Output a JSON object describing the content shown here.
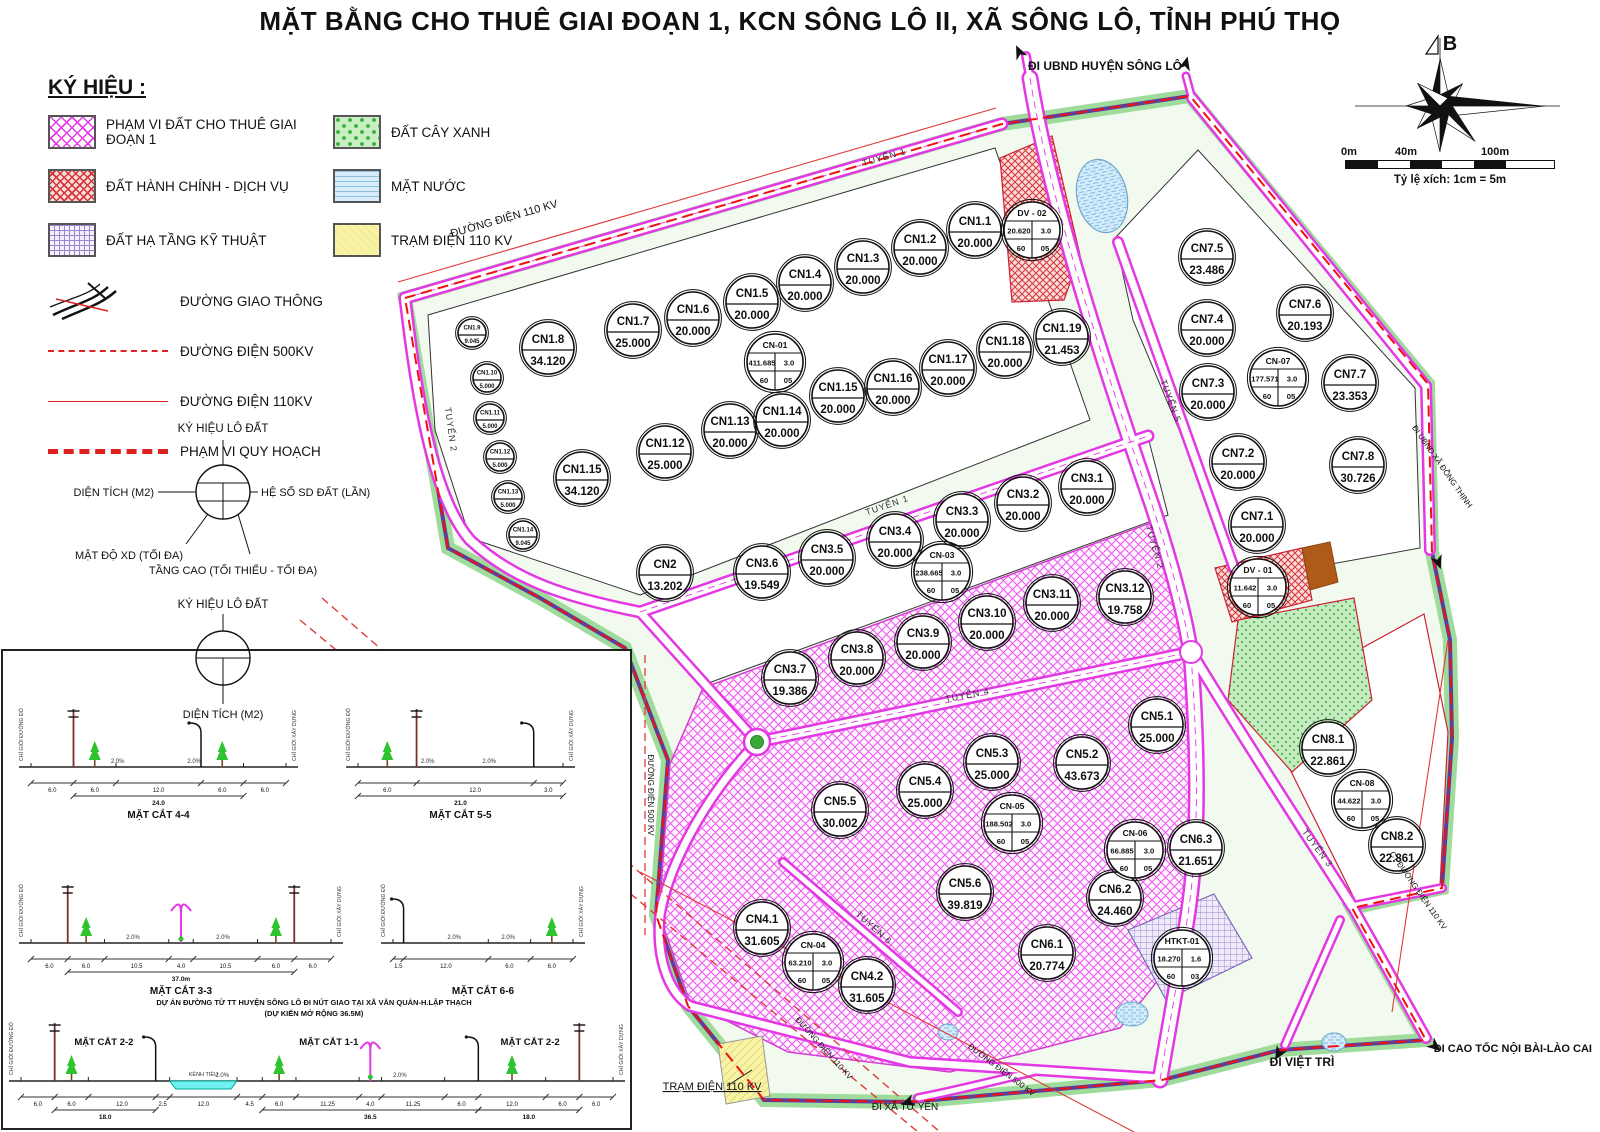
{
  "title": "MẶT BẰNG CHO THUÊ GIAI ĐOẠN 1, KCN SÔNG LÔ II, XÃ SÔNG LÔ, TỈNH PHÚ THỌ",
  "legend": {
    "heading": "KÝ HIỆU :",
    "area_items": [
      {
        "label": "PHẠM VI ĐẤT CHO THUÊ GIAI ĐOẠN 1",
        "k": "phase1"
      },
      {
        "label": "ĐẤT HÀNH CHÍNH - DỊCH VỤ",
        "k": "admin"
      },
      {
        "label": "ĐẤT HẠ TẦNG KỸ THUẬT",
        "k": "htkt"
      },
      {
        "label": "ĐẤT CÂY XANH",
        "k": "green"
      },
      {
        "label": "MẶT NƯỚC",
        "k": "water"
      },
      {
        "label": "TRẠM ĐIỆN 110 KV",
        "k": "power"
      }
    ],
    "line_items": [
      {
        "label": "ĐƯỜNG GIAO THÔNG",
        "k": "road"
      },
      {
        "label": "ĐƯỜNG ĐIỆN 500KV",
        "k": "e500"
      },
      {
        "label": "ĐƯỜNG ĐIỆN 110KV",
        "k": "e110"
      },
      {
        "label": "PHẠM VI QUY HOẠCH",
        "k": "bound"
      }
    ],
    "lot_symbol_full": {
      "title": "KÝ HIỆU LÔ ĐẤT",
      "left": "DIỆN TÍCH (M2)",
      "right": "HỆ SỐ SD ĐẤT (LẦN)",
      "bottom_left": "MẬT ĐỘ XD (TỐI ĐA)",
      "bottom": "TẦNG CAO (TỐI THIỂU - TỐI ĐA)"
    },
    "lot_symbol_simple": {
      "title": "KÝ HIỆU LÔ ĐẤT",
      "bottom": "DIỆN TÍCH (M2)"
    }
  },
  "compass": {
    "north_label": "B"
  },
  "scalebar": {
    "ticks": [
      "0m",
      "40m",
      "100m"
    ],
    "caption": "Tỷ lệ xích: 1cm = 5m"
  },
  "map": {
    "lots": [
      {
        "id": "CN1.8",
        "a": "34.120",
        "x": 548,
        "y": 348
      },
      {
        "id": "CN1.7",
        "a": "25.000",
        "x": 633,
        "y": 330
      },
      {
        "id": "CN1.6",
        "a": "20.000",
        "x": 693,
        "y": 318
      },
      {
        "id": "CN1.5",
        "a": "20.000",
        "x": 752,
        "y": 302
      },
      {
        "id": "CN1.4",
        "a": "20.000",
        "x": 805,
        "y": 283
      },
      {
        "id": "CN1.3",
        "a": "20.000",
        "x": 863,
        "y": 267
      },
      {
        "id": "CN1.2",
        "a": "20.000",
        "x": 920,
        "y": 248
      },
      {
        "id": "CN1.1",
        "a": "20.000",
        "x": 975,
        "y": 230
      },
      {
        "id": "DV - 02",
        "v": [
          "20.620",
          "3.0",
          "60",
          "05"
        ],
        "x": 1032,
        "y": 230
      },
      {
        "id": "CN-01",
        "v": [
          "411.685",
          "3.0",
          "60",
          "05"
        ],
        "x": 775,
        "y": 362
      },
      {
        "id": "CN1.15",
        "a": "34.120",
        "x": 582,
        "y": 478
      },
      {
        "id": "CN1.12",
        "a": "25.000",
        "x": 665,
        "y": 452
      },
      {
        "id": "CN1.13",
        "a": "20.000",
        "x": 730,
        "y": 430
      },
      {
        "id": "CN1.14",
        "a": "20.000",
        "x": 782,
        "y": 420
      },
      {
        "id": "CN1.15",
        "a": "20.000",
        "x": 838,
        "y": 396
      },
      {
        "id": "CN1.16",
        "a": "20.000",
        "x": 893,
        "y": 387
      },
      {
        "id": "CN1.17",
        "a": "20.000",
        "x": 948,
        "y": 368
      },
      {
        "id": "CN1.18",
        "a": "20.000",
        "x": 1005,
        "y": 350
      },
      {
        "id": "CN1.19",
        "a": "21.453",
        "x": 1062,
        "y": 337
      },
      {
        "id": "CN1.9",
        "a": "9.045",
        "s": 1,
        "x": 472,
        "y": 333
      },
      {
        "id": "CN1.10",
        "a": "5.000",
        "s": 1,
        "x": 487,
        "y": 378
      },
      {
        "id": "CN1.11",
        "a": "5.000",
        "s": 1,
        "x": 490,
        "y": 418
      },
      {
        "id": "CN1.12",
        "a": "5.000",
        "s": 1,
        "x": 500,
        "y": 457
      },
      {
        "id": "CN1.13",
        "a": "5.000",
        "s": 1,
        "x": 508,
        "y": 497
      },
      {
        "id": "CN1.14",
        "a": "9.045",
        "s": 1,
        "x": 523,
        "y": 535
      },
      {
        "id": "CN2",
        "a": "13.202",
        "x": 665,
        "y": 573
      },
      {
        "id": "CN3.6",
        "a": "19.549",
        "x": 762,
        "y": 572
      },
      {
        "id": "CN3.5",
        "a": "20.000",
        "x": 827,
        "y": 558
      },
      {
        "id": "CN3.4",
        "a": "20.000",
        "x": 895,
        "y": 540
      },
      {
        "id": "CN3.3",
        "a": "20.000",
        "x": 962,
        "y": 520
      },
      {
        "id": "CN3.2",
        "a": "20.000",
        "x": 1023,
        "y": 503
      },
      {
        "id": "CN3.1",
        "a": "20.000",
        "x": 1087,
        "y": 487
      },
      {
        "id": "CN-03",
        "v": [
          "238.665",
          "3.0",
          "60",
          "05"
        ],
        "x": 942,
        "y": 572
      },
      {
        "id": "CN3.7",
        "a": "19.386",
        "x": 790,
        "y": 678
      },
      {
        "id": "CN3.8",
        "a": "20.000",
        "x": 857,
        "y": 658
      },
      {
        "id": "CN3.9",
        "a": "20.000",
        "x": 923,
        "y": 642
      },
      {
        "id": "CN3.10",
        "a": "20.000",
        "x": 987,
        "y": 622
      },
      {
        "id": "CN3.11",
        "a": "20.000",
        "x": 1052,
        "y": 603
      },
      {
        "id": "CN3.12",
        "a": "19.758",
        "x": 1125,
        "y": 597
      },
      {
        "id": "CN5.1",
        "a": "25.000",
        "x": 1157,
        "y": 725
      },
      {
        "id": "CN5.2",
        "a": "43.673",
        "x": 1082,
        "y": 763
      },
      {
        "id": "CN5.3",
        "a": "25.000",
        "x": 992,
        "y": 762
      },
      {
        "id": "CN5.4",
        "a": "25.000",
        "x": 925,
        "y": 790
      },
      {
        "id": "CN5.5",
        "a": "30.002",
        "x": 840,
        "y": 810
      },
      {
        "id": "CN-05",
        "v": [
          "188.502",
          "3.0",
          "60",
          "05"
        ],
        "x": 1012,
        "y": 823
      },
      {
        "id": "CN5.6",
        "a": "39.819",
        "x": 965,
        "y": 892
      },
      {
        "id": "CN6.1",
        "a": "20.774",
        "x": 1047,
        "y": 953
      },
      {
        "id": "CN6.2",
        "a": "24.460",
        "x": 1115,
        "y": 898
      },
      {
        "id": "CN6.3",
        "a": "21.651",
        "x": 1196,
        "y": 848
      },
      {
        "id": "CN-06",
        "v": [
          "66.885",
          "3.0",
          "60",
          "05"
        ],
        "x": 1135,
        "y": 850
      },
      {
        "id": "CN4.1",
        "a": "31.605",
        "x": 762,
        "y": 928
      },
      {
        "id": "CN-04",
        "v": [
          "63.210",
          "3.0",
          "60",
          "05"
        ],
        "x": 813,
        "y": 962
      },
      {
        "id": "CN4.2",
        "a": "31.605",
        "x": 867,
        "y": 985
      },
      {
        "id": "HTKT-01",
        "v": [
          "18.270",
          "1.6",
          "60",
          "03"
        ],
        "x": 1182,
        "y": 958
      },
      {
        "id": "CN7.5",
        "a": "23.486",
        "x": 1207,
        "y": 257
      },
      {
        "id": "CN7.4",
        "a": "20.000",
        "x": 1207,
        "y": 328
      },
      {
        "id": "CN7.6",
        "a": "20.193",
        "x": 1305,
        "y": 313
      },
      {
        "id": "CN7.3",
        "a": "20.000",
        "x": 1208,
        "y": 392
      },
      {
        "id": "CN-07",
        "v": [
          "177.571",
          "3.0",
          "60",
          "05"
        ],
        "x": 1278,
        "y": 378
      },
      {
        "id": "CN7.7",
        "a": "23.353",
        "x": 1350,
        "y": 383
      },
      {
        "id": "CN7.2",
        "a": "20.000",
        "x": 1238,
        "y": 462
      },
      {
        "id": "CN7.8",
        "a": "30.726",
        "x": 1358,
        "y": 465
      },
      {
        "id": "CN7.1",
        "a": "20.000",
        "x": 1257,
        "y": 525
      },
      {
        "id": "DV - 01",
        "v": [
          "11.642",
          "3.0",
          "60",
          "05"
        ],
        "x": 1258,
        "y": 587
      },
      {
        "id": "CN8.1",
        "a": "22.861",
        "x": 1328,
        "y": 748
      },
      {
        "id": "CN-08",
        "v": [
          "44.622",
          "3.0",
          "60",
          "05"
        ],
        "x": 1362,
        "y": 800
      },
      {
        "id": "CN8.2",
        "a": "22.861",
        "x": 1397,
        "y": 845
      }
    ],
    "road_labels": [
      {
        "t": "TUYẾN 1",
        "x": 885,
        "y": 160,
        "r": -16
      },
      {
        "t": "TUYẾN 2",
        "x": 448,
        "y": 430,
        "r": 82
      },
      {
        "t": "TUYẾN 1",
        "x": 888,
        "y": 508,
        "r": -19
      },
      {
        "t": "TUYẾN 4",
        "x": 968,
        "y": 698,
        "r": -11
      },
      {
        "t": "TUYẾN 5",
        "x": 1168,
        "y": 402,
        "r": 70
      },
      {
        "t": "TUYẾN 2",
        "x": 1152,
        "y": 548,
        "r": 74
      },
      {
        "t": "TUYẾN 3",
        "x": 1315,
        "y": 850,
        "r": 53
      },
      {
        "t": "TUYẾN 6",
        "x": 872,
        "y": 930,
        "r": 42
      }
    ],
    "labels": [
      {
        "t": "ĐI UBND HUYỆN SÔNG LÔ",
        "x": 1105,
        "y": 70,
        "r": 0,
        "s": 12,
        "b": 1
      },
      {
        "t": "ĐƯỜNG ĐIỆN 110 KV",
        "x": 505,
        "y": 222,
        "r": -16,
        "s": 11,
        "b": 0
      },
      {
        "t": "TRẠM ĐIỆN 110 KV",
        "x": 712,
        "y": 1090,
        "r": 0,
        "s": 11,
        "b": 0,
        "u": 1
      },
      {
        "t": "ĐI XÃ TỬ YÊN",
        "x": 905,
        "y": 1110,
        "r": 0,
        "s": 10,
        "b": 0
      },
      {
        "t": "ĐI VIỆT TRÌ",
        "x": 1302,
        "y": 1066,
        "r": 0,
        "s": 12,
        "b": 1
      },
      {
        "t": "ĐI CAO TỐC NỘI BÀI-LÀO CAI",
        "x": 1592,
        "y": 1052,
        "r": 0,
        "s": 11,
        "b": 1,
        "anchor": "end"
      },
      {
        "t": "ĐƯỜNG ĐIỆN 110 KV",
        "x": 822,
        "y": 1050,
        "r": 48,
        "s": 8,
        "b": 0
      },
      {
        "t": "ĐƯỜNG ĐIỆN 500 KV",
        "x": 1000,
        "y": 1072,
        "r": 37,
        "s": 8,
        "b": 0
      },
      {
        "t": "ĐƯỜNG ĐIỆN 500 KV",
        "x": 648,
        "y": 795,
        "r": 90,
        "s": 8,
        "b": 0
      },
      {
        "t": "CT ĐƯỜNG ĐIỆN 110 KV",
        "x": 1416,
        "y": 892,
        "r": 55,
        "s": 8,
        "b": 0
      },
      {
        "t": "ĐI UBND XÃ ĐỒNG THỊNH",
        "x": 1440,
        "y": 468,
        "r": 55,
        "s": 8,
        "b": 0
      }
    ]
  },
  "sections": {
    "note1": "DỰ ÁN ĐƯỜNG TỪ TT HUYỆN SÔNG LÔ ĐI NÚT GIAO TẠI XÃ VĂN QUÁN-H.LẬP THẠCH",
    "note2": "(DỰ KIẾN MỞ RỘNG 36.5M)",
    "slope": "2.0%",
    "edge_labels": [
      "CHỈ GIỚI ĐƯỜNG ĐỎ",
      "CHỈ GIỚI XÂY DỰNG"
    ],
    "canal_label": "KÊNH TIÊU",
    "items": [
      {
        "name": "MẶT CẮT 4-4",
        "dims": [
          "6.0",
          "6.0",
          "12.0",
          "6.0",
          "6.0"
        ],
        "total": {
          "t": "24.0",
          "a": 1,
          "b": 3
        },
        "trees": [
          1,
          3
        ],
        "poles": [
          1
        ],
        "lamps": [
          3
        ],
        "ox": 28,
        "oy": 20,
        "w": 255,
        "h": 138
      },
      {
        "name": "MẶT CẮT 5-5",
        "dims": [
          "6.0",
          "12.0",
          "3.0"
        ],
        "total": {
          "t": "21.0",
          "a": 0,
          "b": 2
        },
        "trees": [
          0
        ],
        "poles": [
          1
        ],
        "lamps": [
          2
        ],
        "ox": 355,
        "oy": 20,
        "w": 205,
        "h": 138
      },
      {
        "name": "MẶT CẮT 3-3",
        "dims": [
          "6.0",
          "6.0",
          "10.5",
          "4.0",
          "10.5",
          "6.0",
          "6.0"
        ],
        "total": {
          "t": "37.0m",
          "a": 1,
          "b": 5
        },
        "trees": [
          1,
          5
        ],
        "poles": [
          1,
          6
        ],
        "median": 3,
        "ox": 28,
        "oy": 182,
        "w": 300,
        "h": 152
      },
      {
        "name": "MẶT CẮT 6-6",
        "dims": [
          "1.5",
          "12.0",
          "6.0",
          "6.0"
        ],
        "trees": [
          3
        ],
        "lamps": [
          1
        ],
        "ox": 390,
        "oy": 200,
        "w": 180,
        "h": 134
      },
      {
        "name": "",
        "labels": [
          {
            "t": "MẶT CẮT 2-2",
            "f": 0.14
          },
          {
            "t": "MẶT CẮT 1-1",
            "f": 0.52
          },
          {
            "t": "MẶT CẮT 2-2",
            "f": 0.86
          }
        ],
        "dims": [
          "6.0",
          "6.0",
          "12.0",
          "2.5",
          "12.0",
          "4.5",
          "6.0",
          "11.25",
          "4.0",
          "11.25",
          "6.0",
          "12.0",
          "6.0",
          "6.0"
        ],
        "groups": [
          {
            "a": 1,
            "b": 2,
            "t": "18.0"
          },
          {
            "a": 6,
            "b": 10,
            "t": "36.5"
          },
          {
            "a": 11,
            "b": 12,
            "t": "18.0"
          }
        ],
        "canal": 4,
        "trees": [
          1,
          6,
          11
        ],
        "poles": [
          1,
          13
        ],
        "lamps": [
          3,
          11
        ],
        "median": 8,
        "ox": 18,
        "oy": 388,
        "w": 592,
        "h": 84
      }
    ]
  }
}
